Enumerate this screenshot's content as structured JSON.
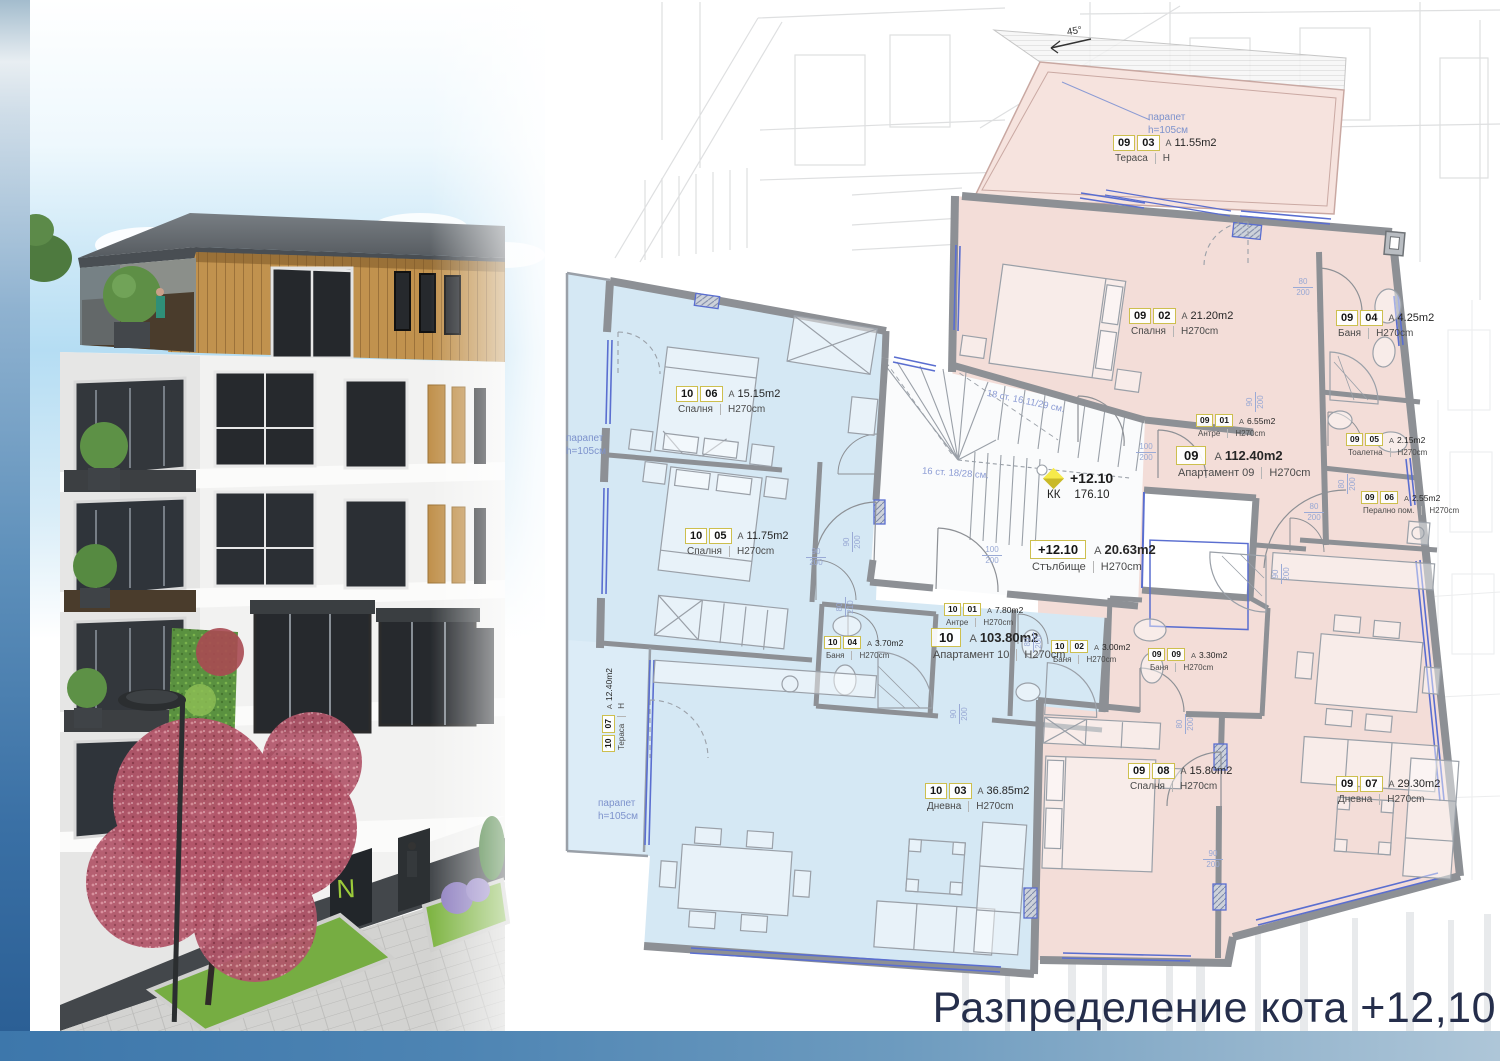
{
  "page": {
    "title": "Разпределение кота +12,10",
    "north_mark": "45°"
  },
  "plan": {
    "level_marker": {
      "level": "+12.10",
      "kk_label": "КК",
      "kk_value": "176.10"
    },
    "stair_flight_top": "18 ст. 16.11/29 см.",
    "stair_flight_bottom": "16 ст. 18/28 см.",
    "apartment_labels": [
      {
        "num": "10",
        "area": "103.80m2",
        "name": "Апартамент 10",
        "height": "H270cm",
        "x": 931,
        "y": 628
      },
      {
        "num": "09",
        "area": "112.40m2",
        "name": "Апартамент 09",
        "height": "H270cm",
        "x": 1176,
        "y": 446
      },
      {
        "num": "+12.10",
        "area": "20.63m2",
        "name": "Стълбище",
        "height": "H270cm",
        "x": 1030,
        "y": 540
      }
    ],
    "rooms": [
      {
        "n1": "10",
        "n2": "06",
        "area": "15.15m2",
        "name": "Спалня",
        "height": "H270cm",
        "x": 676,
        "y": 386,
        "small": false,
        "rot": false
      },
      {
        "n1": "10",
        "n2": "05",
        "area": "11.75m2",
        "name": "Спалня",
        "height": "H270cm",
        "x": 685,
        "y": 528,
        "small": false,
        "rot": false
      },
      {
        "n1": "10",
        "n2": "04",
        "area": "3.70m2",
        "name": "Баня",
        "height": "H270cm",
        "x": 824,
        "y": 636,
        "small": true,
        "rot": false
      },
      {
        "n1": "10",
        "n2": "01",
        "area": "7.80m2",
        "name": "Антре",
        "height": "H270cm",
        "x": 944,
        "y": 603,
        "small": true,
        "rot": false
      },
      {
        "n1": "10",
        "n2": "02",
        "area": "3.00m2",
        "name": "Баня",
        "height": "H270cm",
        "x": 1051,
        "y": 640,
        "small": true,
        "rot": false
      },
      {
        "n1": "10",
        "n2": "03",
        "area": "36.85m2",
        "name": "Дневна",
        "height": "H270cm",
        "x": 925,
        "y": 783,
        "small": false,
        "rot": false
      },
      {
        "n1": "10",
        "n2": "07",
        "area": "12.40m2",
        "name": "Тераса",
        "height": "Н",
        "x": 602,
        "y": 752,
        "small": true,
        "rot": true
      },
      {
        "n1": "09",
        "n2": "03",
        "area": "11.55m2",
        "name": "Тераса",
        "height": "Н",
        "x": 1113,
        "y": 135,
        "small": false,
        "rot": false
      },
      {
        "n1": "09",
        "n2": "02",
        "area": "21.20m2",
        "name": "Спалня",
        "height": "H270cm",
        "x": 1129,
        "y": 308,
        "small": false,
        "rot": false
      },
      {
        "n1": "09",
        "n2": "04",
        "area": "4.25m2",
        "name": "Баня",
        "height": "H270cm",
        "x": 1336,
        "y": 310,
        "small": false,
        "rot": false
      },
      {
        "n1": "09",
        "n2": "01",
        "area": "6.55m2",
        "name": "Антре",
        "height": "H270cm",
        "x": 1196,
        "y": 414,
        "small": true,
        "rot": false
      },
      {
        "n1": "09",
        "n2": "05",
        "area": "2.15m2",
        "name": "Тоалетна",
        "height": "H270cm",
        "x": 1346,
        "y": 433,
        "small": true,
        "rot": false
      },
      {
        "n1": "09",
        "n2": "06",
        "area": "2.55m2",
        "name": "Перално пом.",
        "height": "H270cm",
        "x": 1361,
        "y": 491,
        "small": true,
        "rot": false
      },
      {
        "n1": "09",
        "n2": "09",
        "area": "3.30m2",
        "name": "Баня",
        "height": "H270cm",
        "x": 1148,
        "y": 648,
        "small": true,
        "rot": false
      },
      {
        "n1": "09",
        "n2": "08",
        "area": "15.80m2",
        "name": "Спалня",
        "height": "H270cm",
        "x": 1128,
        "y": 763,
        "small": false,
        "rot": false
      },
      {
        "n1": "09",
        "n2": "07",
        "area": "29.30m2",
        "name": "Дневна",
        "height": "H270cm",
        "x": 1336,
        "y": 776,
        "small": false,
        "rot": false
      }
    ],
    "parapet_labels": [
      {
        "line1": "парапет",
        "line2": "h=105см",
        "x": 566,
        "y": 433
      },
      {
        "line1": "парапет",
        "line2": "h=105см",
        "x": 598,
        "y": 798
      },
      {
        "line1": "парапет",
        "line2": "h=105см",
        "x": 1148,
        "y": 112
      }
    ],
    "door_dims": [
      {
        "w": "90",
        "h": "200",
        "x": 806,
        "y": 548,
        "v": false
      },
      {
        "w": "100",
        "h": "200",
        "x": 982,
        "y": 546,
        "v": false
      },
      {
        "w": "100",
        "h": "200",
        "x": 1136,
        "y": 443,
        "v": false
      },
      {
        "w": "80",
        "h": "200",
        "x": 1293,
        "y": 278,
        "v": false
      },
      {
        "w": "80",
        "h": "200",
        "x": 1304,
        "y": 503,
        "v": false
      },
      {
        "w": "90",
        "h": "200",
        "x": 1203,
        "y": 850,
        "v": false
      },
      {
        "w": "90",
        "h": "200",
        "x": 843,
        "y": 552,
        "v": true
      },
      {
        "w": "80",
        "h": "210",
        "x": 836,
        "y": 617,
        "v": true
      },
      {
        "w": "80",
        "h": "200",
        "x": 1024,
        "y": 652,
        "v": true
      },
      {
        "w": "90",
        "h": "200",
        "x": 950,
        "y": 724,
        "v": true
      },
      {
        "w": "80",
        "h": "200",
        "x": 1176,
        "y": 734,
        "v": true
      },
      {
        "w": "90",
        "h": "200",
        "x": 1246,
        "y": 412,
        "v": true
      },
      {
        "w": "80",
        "h": "200",
        "x": 1338,
        "y": 494,
        "v": true
      },
      {
        "w": "90",
        "h": "200",
        "x": 1272,
        "y": 584,
        "v": true
      }
    ]
  }
}
